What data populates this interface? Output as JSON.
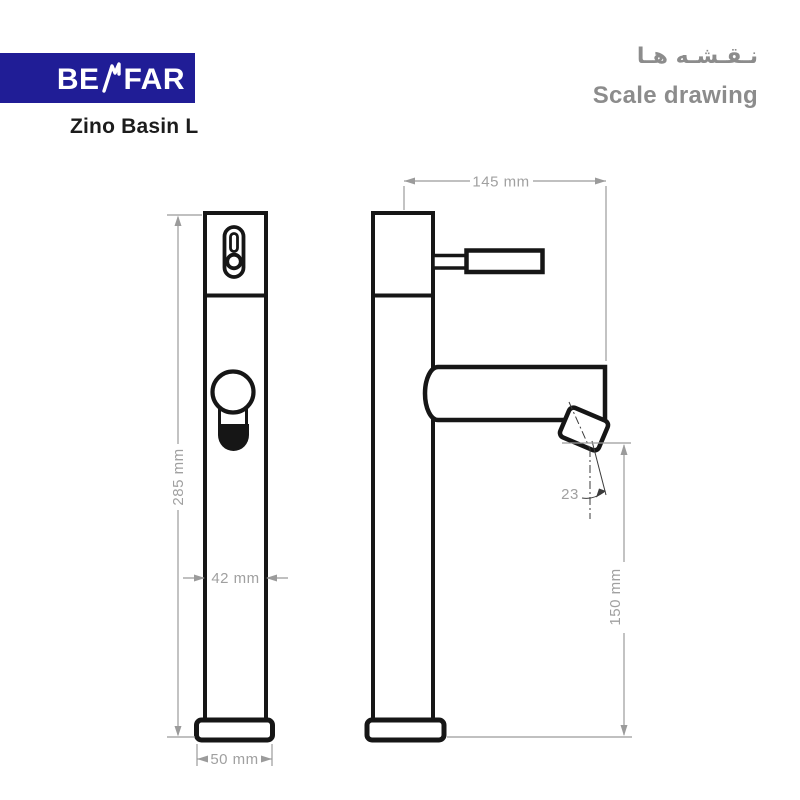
{
  "header": {
    "brand_prefix": "BE",
    "brand_suffix": "FAR",
    "product_name": "Zino Basin L",
    "title_fa": "نـقـشـه هـا",
    "title_en": "Scale drawing"
  },
  "colors": {
    "brand_blue": "#201d96",
    "drawing_black": "#161616",
    "dimension_gray": "#9b9b9b",
    "header_gray": "#8c8c8c"
  },
  "drawing": {
    "type": "technical scale drawing, faucet front and side views",
    "dimensions": {
      "total_height": "285 mm",
      "body_width": "42 mm",
      "base_width": "50 mm",
      "spout_reach": "145 mm",
      "spout_height": "150 mm",
      "spout_angle_deg": "23"
    }
  }
}
